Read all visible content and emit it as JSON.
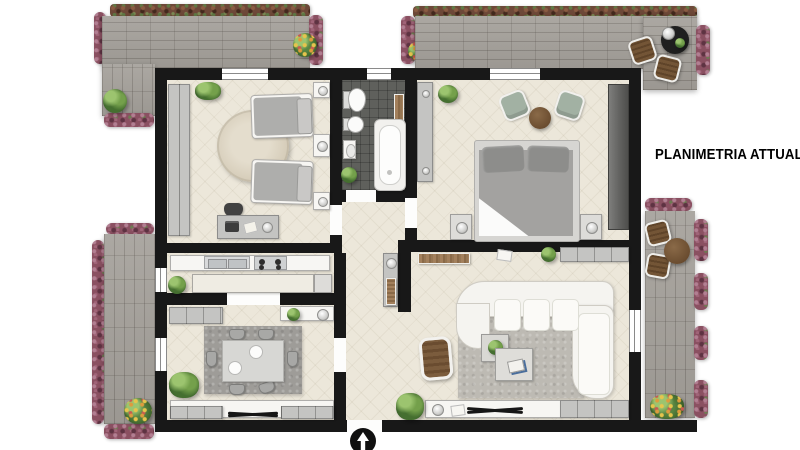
{
  "title": "PLANIMETRIA ATTUALE",
  "plan": {
    "type": "residential floor plan, top view",
    "north_indicator": "arrow pointing up at bottom entrance",
    "rooms": [
      {
        "name": "bedroom-2",
        "furniture": [
          "wardrobe",
          "single bed",
          "single bed",
          "nightstands with lamps",
          "round rug",
          "desk with laptop",
          "desk chair",
          "plant"
        ]
      },
      {
        "name": "bathroom",
        "furniture": [
          "toilet",
          "bidet",
          "washbasin",
          "bathtub",
          "wooden shelf",
          "plant"
        ]
      },
      {
        "name": "master-bedroom",
        "furniture": [
          "wardrobe",
          "tall dark wardrobe",
          "double bed",
          "nightstand with lamp",
          "nightstand with lamp",
          "lounge chair",
          "lounge chair",
          "round side table",
          "plant"
        ]
      },
      {
        "name": "kitchen",
        "furniture": [
          "counter with double sink",
          "gas hob",
          "island counter",
          "side cabinet",
          "plant"
        ]
      },
      {
        "name": "dining-room",
        "furniture": [
          "dining table",
          "six chairs",
          "two plates",
          "rug",
          "sideboard",
          "console with lamp and plant",
          "low cabinets",
          "decor console",
          "plant"
        ]
      },
      {
        "name": "hallway",
        "furniture": [
          "cabinet with lamp",
          "slatted rack"
        ]
      },
      {
        "name": "living-room",
        "furniture": [
          "corner sofa",
          "rug",
          "coffee table with plant",
          "coffee table with magazines",
          "wooden armchair",
          "slatted sideboard",
          "tv console",
          "wall cabinets",
          "plants"
        ]
      }
    ],
    "terraces": [
      {
        "name": "terrace-top-left",
        "features": [
          "brick paving",
          "flower hedges",
          "plants"
        ]
      },
      {
        "name": "terrace-top-right",
        "features": [
          "brick paving",
          "flower hedges",
          "two lounge chairs",
          "black round table with lamp and plant"
        ]
      },
      {
        "name": "terrace-left",
        "features": [
          "brick paving",
          "flower hedges",
          "flowering plant"
        ]
      },
      {
        "name": "terrace-right",
        "features": [
          "brick paving",
          "flower hedges",
          "two lounge chairs",
          "round wooden table",
          "flowering plant"
        ]
      }
    ],
    "openings": [
      "entrance door at bottom",
      "six windows",
      "interior door openings"
    ]
  },
  "colors": {
    "background": "#ffffff",
    "walls": "#181818",
    "room_floor": "#ece7da",
    "bathroom_tile": "#5f605c",
    "paving": "#a5a19b",
    "hedge": "#8a5061",
    "foliage": "#53813a",
    "wood": "#7a5a3b",
    "title_text": "#000000"
  }
}
